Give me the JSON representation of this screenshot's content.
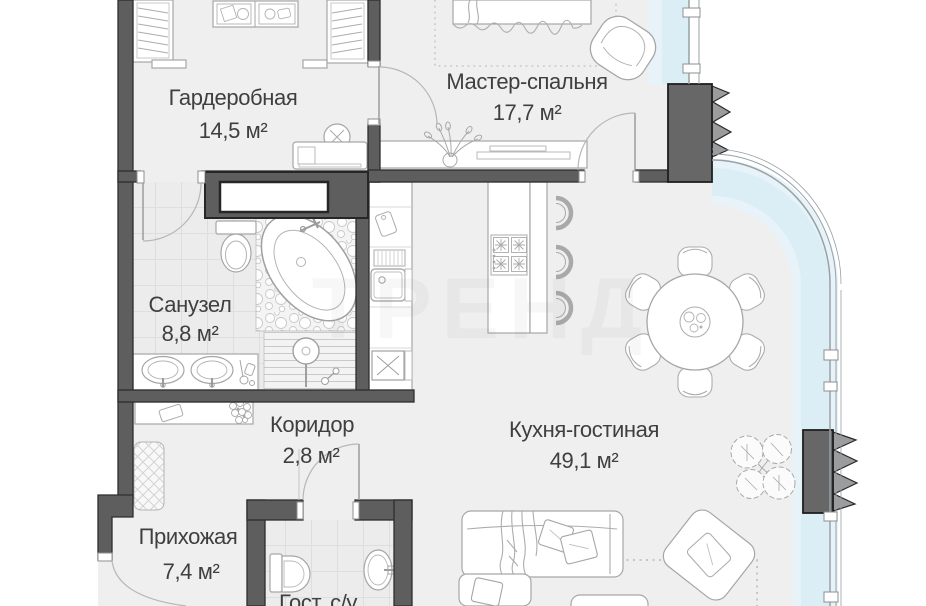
{
  "plan": {
    "type": "apartment-floor-plan",
    "watermark": "ТРЕНД",
    "rooms": {
      "wardrobe": {
        "label": "Гардеробная",
        "area": "14,5 м²"
      },
      "master_bedroom": {
        "label": "Мастер-спальня",
        "area": "17,7 м²"
      },
      "bathroom": {
        "label": "Санузел",
        "area": "8,8 м²"
      },
      "corridor": {
        "label": "Коридор",
        "area": "2,8 м²"
      },
      "kitchen_living": {
        "label": "Кухня-гостиная",
        "area": "49,1 м²"
      },
      "hallway": {
        "label": "Прихожая",
        "area": "7,4 м²"
      },
      "guest_wc": {
        "label": "Гост. с/у"
      }
    },
    "colors": {
      "wall": "#5e5e5e",
      "wall_outline": "#2e2e2e",
      "floor": "#efefef",
      "glass_tint": "#d9ecf5",
      "furniture_line": "#a6a6a6",
      "column_hatch": "#9c9c9c",
      "label_text": "#3f3f3f"
    }
  }
}
